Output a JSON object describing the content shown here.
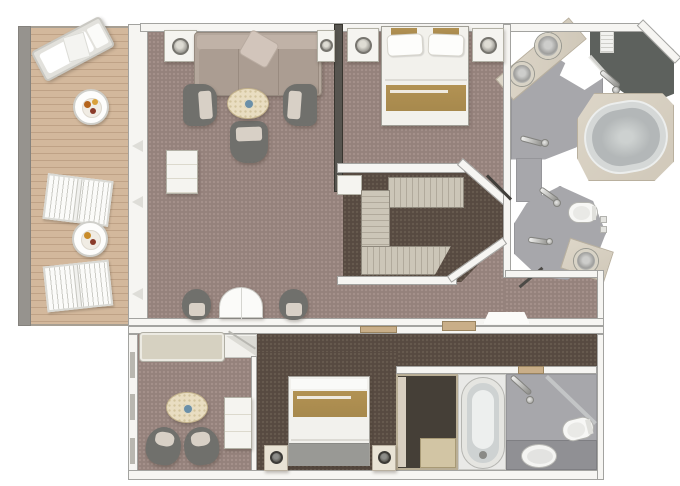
{
  "meta": {
    "type": "floor-plan",
    "description": "Top-down rendered floor plan of a two-bedroom suite with private veranda, living room, master bedroom, walk-in closet, two master bathrooms and a connecting second stateroom with its own bathroom."
  },
  "palette": {
    "page-bg": "#ffffff",
    "wall-fill": "#f6f5f2",
    "wall-line": "#a3a3a0",
    "carpet-main": "#95827c",
    "carpet-main-dot": "#a4918b",
    "carpet-dark": "#574a41",
    "carpet-dark-dot": "#675a4f",
    "deck": "#d3b89c",
    "deck-line": "#bfa286",
    "deck-rail": "#96938e",
    "bath-floor": "#a7a7ab",
    "bath-floor-dark": "#909094",
    "shower-dark": "#5d615d",
    "marble": "#d8d1c3",
    "marble-line": "#b9b09e",
    "gold": "#a7894d",
    "sofa": "#b4a79c",
    "chair-dark": "#70706c",
    "cushion": "#d8d0c6",
    "table-cream": "#e9ddc1",
    "furn-white": "#f5f4f0",
    "tub-gray": "#b3b7b8",
    "accent-blue": "#6a8fa8",
    "wood": "#c9ae88"
  },
  "rooms": {
    "balcony": "Private veranda with sun lounger, two deck chairs and round tables",
    "living_room": "Living room with sofa, three armchairs, coffee table and desk",
    "dining_area": "Dining table with two chairs",
    "master_bedroom": "Master bedroom with bed and two nightstands",
    "walk_in_closet": "Walk-in wardrobe",
    "master_bathroom": "Master bathroom with double vanity, oval tub and shower room",
    "second_bathroom": "Second bathroom with shower, toilet and vanity sink",
    "second_sitting": "Second stateroom sitting area with sofa, table and two chairs",
    "second_bedroom": "Second bedroom with bed, nightstands and wardrobe",
    "second_bath": "Second stateroom bathroom with tub, shower, toilet and sink"
  },
  "furniture": {
    "balcony": [
      "sun lounger",
      "round table with breakfast tray",
      "slatted deck chair",
      "slatted deck chair",
      "round table with breakfast tray"
    ],
    "living_room": [
      "sofa with throw pillow",
      "side table with lamp",
      "side table with lamp",
      "armchair",
      "armchair",
      "armchair",
      "oval coffee table",
      "writing desk"
    ],
    "dining_area": [
      "round drop-leaf table",
      "dining chair",
      "dining chair"
    ],
    "master_bedroom": [
      "double bed with gold runner",
      "nightstand with lamp",
      "nightstand with lamp"
    ],
    "walk_in_closet": [
      "c-shaped wardrobe shelving",
      "linen shelf"
    ],
    "master_bathroom": [
      "double vanity with two round sinks",
      "oval bathtub on marble deck",
      "walk-in shower with bath mat",
      "hand shower"
    ],
    "second_bathroom": [
      "toilet",
      "vanity with round sink",
      "shower head",
      "hand shower"
    ],
    "second_sitting": [
      "sofa",
      "oval table",
      "tub chair",
      "tub chair",
      "tall cabinet"
    ],
    "second_bedroom": [
      "double bed with gold runner",
      "nightstand with lamp",
      "nightstand with lamp",
      "wardrobe"
    ],
    "second_bath": [
      "bathtub",
      "shower with glass panel",
      "toilet",
      "oval sink"
    ]
  }
}
